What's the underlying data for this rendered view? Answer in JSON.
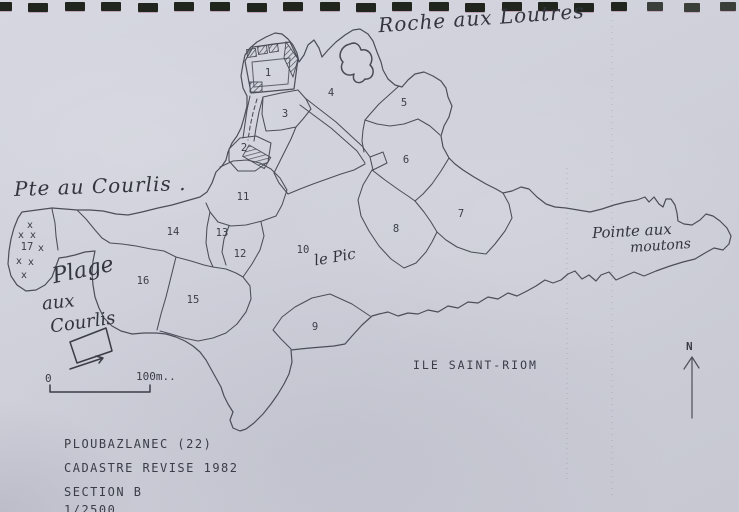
{
  "colors": {
    "paper": "#cfd0da",
    "print_ink": "#4b4e58",
    "hand_ink": "#33353e",
    "binding_mark": "#20261e"
  },
  "binding": {
    "count": 21
  },
  "map": {
    "island_name_label": "ILE SAINT-RIOM",
    "north_label": "N",
    "scale": {
      "zero": "0",
      "distance": "100m.."
    },
    "x_mark": "x",
    "x_marks": [
      [
        30,
        228
      ],
      [
        21,
        238
      ],
      [
        33,
        238
      ],
      [
        41,
        251
      ],
      [
        19,
        264
      ],
      [
        31,
        265
      ],
      [
        24,
        278
      ]
    ],
    "parcels": [
      {
        "id": "1",
        "x": 268,
        "y": 76
      },
      {
        "id": "2",
        "x": 244,
        "y": 151
      },
      {
        "id": "3",
        "x": 285,
        "y": 117
      },
      {
        "id": "4",
        "x": 331,
        "y": 96
      },
      {
        "id": "5",
        "x": 404,
        "y": 106
      },
      {
        "id": "6",
        "x": 406,
        "y": 163
      },
      {
        "id": "7",
        "x": 461,
        "y": 217
      },
      {
        "id": "8",
        "x": 396,
        "y": 232
      },
      {
        "id": "9",
        "x": 315,
        "y": 330
      },
      {
        "id": "10",
        "x": 303,
        "y": 253
      },
      {
        "id": "11",
        "x": 243,
        "y": 200
      },
      {
        "id": "12",
        "x": 240,
        "y": 257
      },
      {
        "id": "13",
        "x": 222,
        "y": 236
      },
      {
        "id": "14",
        "x": 173,
        "y": 235
      },
      {
        "id": "15",
        "x": 193,
        "y": 303
      },
      {
        "id": "16",
        "x": 143,
        "y": 284
      },
      {
        "id": "17",
        "x": 27,
        "y": 250
      }
    ]
  },
  "annotations": {
    "roche": "Roche aux Loutres",
    "pte_courlis": "Pte au Courlis .",
    "plage": "Plage",
    "aux": "aux",
    "courlis": "Courlis",
    "le_pic": "le Pic",
    "pointe_aux": "Pointe aux",
    "moutons": "moutons"
  },
  "cartouche": {
    "line1": "PLOUBAZLANEC (22)",
    "line2": "CADASTRE REVISE 1982",
    "line3": "SECTION B",
    "line4": "1/2500"
  }
}
